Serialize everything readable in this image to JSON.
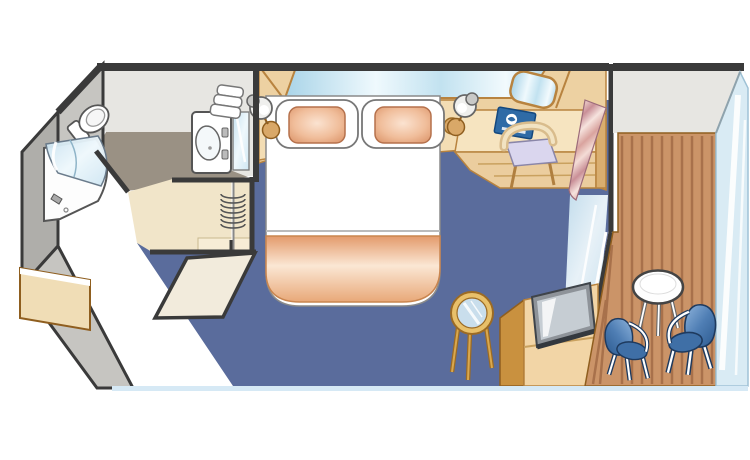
{
  "diagram": {
    "kind": "floor-plan",
    "label": "Balcony stateroom floor plan",
    "rooms": [
      "Bathroom",
      "Entry and closet",
      "Stateroom",
      "Private balcony"
    ]
  },
  "labels": {
    "plan": "Balcony stateroom floor plan",
    "bathroom": "Bathroom",
    "toilet": "Toilet",
    "bathtub": "Bathtub with shower glass",
    "vanity": "Sink vanity",
    "towels": "Stacked towels",
    "bathroomMirror": "Bathroom mirror",
    "hallway": "Entry hallway and closet",
    "entryDoor": "Entry door (open)",
    "hangers": "Closet hanger rail",
    "bedroom": "Stateroom",
    "bed": "Queen bed",
    "pillowLeft": "Pillow",
    "pillowRight": "Pillow",
    "blanket": "Blanket",
    "headboardMirror": "Headboard mirror",
    "nightstandLeft": "Nightstand",
    "nightstandRight": "Nightstand",
    "lampLeft": "Reading lamp",
    "lampRight": "Reading lamp",
    "desk": "Desk with drawers",
    "deskMirror": "Desk mirror",
    "deskChair": "Desk chair",
    "guestBook": "Guest information book",
    "sideTable": "Glass-top side table",
    "tvCabinet": "TV cabinet",
    "tv": "Flat-screen TV",
    "curtain": "Curtain",
    "balconyDoor": "Sliding glass balcony door",
    "balcony": "Private balcony",
    "deck": "Teak deck",
    "balconyTable": "Balcony table",
    "balconyChairLeft": "Balcony chair",
    "balconyChairRight": "Balcony chair",
    "railing": "Glass railing",
    "exterior": "Exterior bulkheads"
  },
  "colors": {
    "carpet": "#5A6C9C",
    "bathroom_floor": "#9A9184",
    "hallway_floor": "#F1E5C9",
    "deck_wood": "#CB9468",
    "plank_line": "#A8714B",
    "wall_interior": "#E7E6E2",
    "wall_exterior": "#C6C5C1",
    "outline": "#3A3A3A",
    "furniture_tan": "#F6E4C0",
    "furniture_tan_mid": "#EDD1A2",
    "furniture_tan_dark": "#C9913F",
    "bed_white": "#FFFFFF",
    "pillow_peach": "#DD9A70",
    "blanket_peach": "#E8A174",
    "mirror_blue": "#BEE0F0",
    "glass_blue": "#D9EBF4",
    "chair_blue": "#4F7EB4",
    "curtain_pink": "#E7B6AE",
    "book_blue": "#2F6BA6",
    "seat_lavender": "#DAD6EE",
    "table_gold": "#E8C06A",
    "bottom_strip": "#D6E9F5"
  }
}
